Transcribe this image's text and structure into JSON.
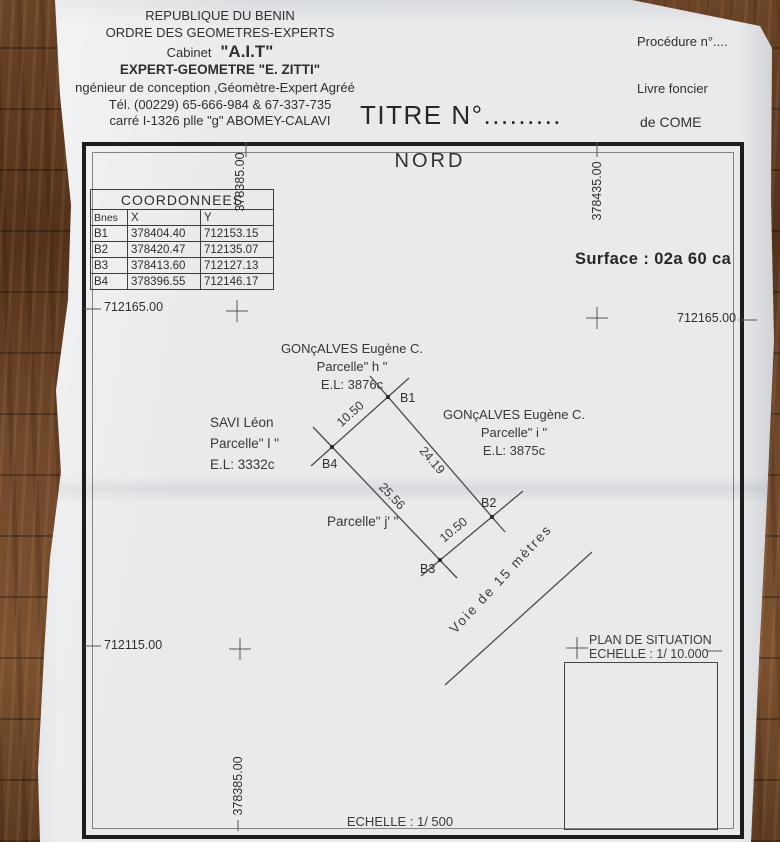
{
  "header": {
    "org_line1": "REPUBLIQUE DU BENIN",
    "org_line2": "ORDRE DES GEOMETRES-EXPERTS",
    "cabinet_prefix": "Cabinet",
    "cabinet_name": "\"A.I.T\"",
    "expert_line": "EXPERT-GEOMETRE \"E. ZITTI\"",
    "engineer_line": "ngénieur de conception ,Géomètre-Expert Agréé",
    "phone_line": "Tél. (00229) 65-666-984 & 67-337-735",
    "address_line": "carré I-1326 plle \"g\"  ABOMEY-CALAVI",
    "title_number": "TITRE N°.........",
    "procedure": "Procédure n°....",
    "land_book": "Livre foncier",
    "of_place": "de  COME"
  },
  "plan": {
    "north": "NORD",
    "surface": "Surface : 02a 60 ca",
    "table": {
      "title": "COORDONNEES",
      "col_bnes": "Bnes",
      "col_x": "X",
      "col_y": "Y",
      "rows": [
        {
          "b": "B1",
          "x": "378404.40",
          "y": "712153.15"
        },
        {
          "b": "B2",
          "x": "378420.47",
          "y": "712135.07"
        },
        {
          "b": "B3",
          "x": "378413.60",
          "y": "712127.13"
        },
        {
          "b": "B4",
          "x": "378396.55",
          "y": "712146.17"
        }
      ]
    },
    "grid": {
      "easting_top_left": "378385.00",
      "easting_top_right": "378435.00",
      "easting_bottom": "378385.00",
      "northing_left_upper": "712165.00",
      "northing_right_upper": "712165.00",
      "northing_left_lower": "712115.00"
    },
    "neighbors": {
      "north_owner": "GONçALVES Eugène C.",
      "north_parcel": "Parcelle\" h \"",
      "north_el": "E.L: 3876c",
      "west_owner": "SAVI Léon",
      "west_parcel": "Parcelle\" l \"",
      "west_el": "E.L: 3332c",
      "east_owner": "GONçALVES Eugène C.",
      "east_parcel": "Parcelle\" i \"",
      "east_el": "E.L: 3875c",
      "south_parcel": "Parcelle\" j' \""
    },
    "parcel": {
      "corner_b1": "B1",
      "corner_b2": "B2",
      "corner_b3": "B3",
      "corner_b4": "B4",
      "len_b4_b1": "10.50",
      "len_b1_b2": "24.19",
      "len_b4_b3": "25.56",
      "len_b3_b2": "10.50",
      "road": "Voie  de  15  mètres"
    },
    "situation": {
      "line1": "PLAN DE SITUATION",
      "line2": "ECHELLE : 1/ 10.000"
    },
    "scale": "ECHELLE : 1/ 500"
  },
  "colors": {
    "paper": "#e8eaec",
    "ink": "#2e2f33",
    "line": "#4a4b4f",
    "frame": "#1d1d20",
    "wood": "#5d3a22"
  }
}
